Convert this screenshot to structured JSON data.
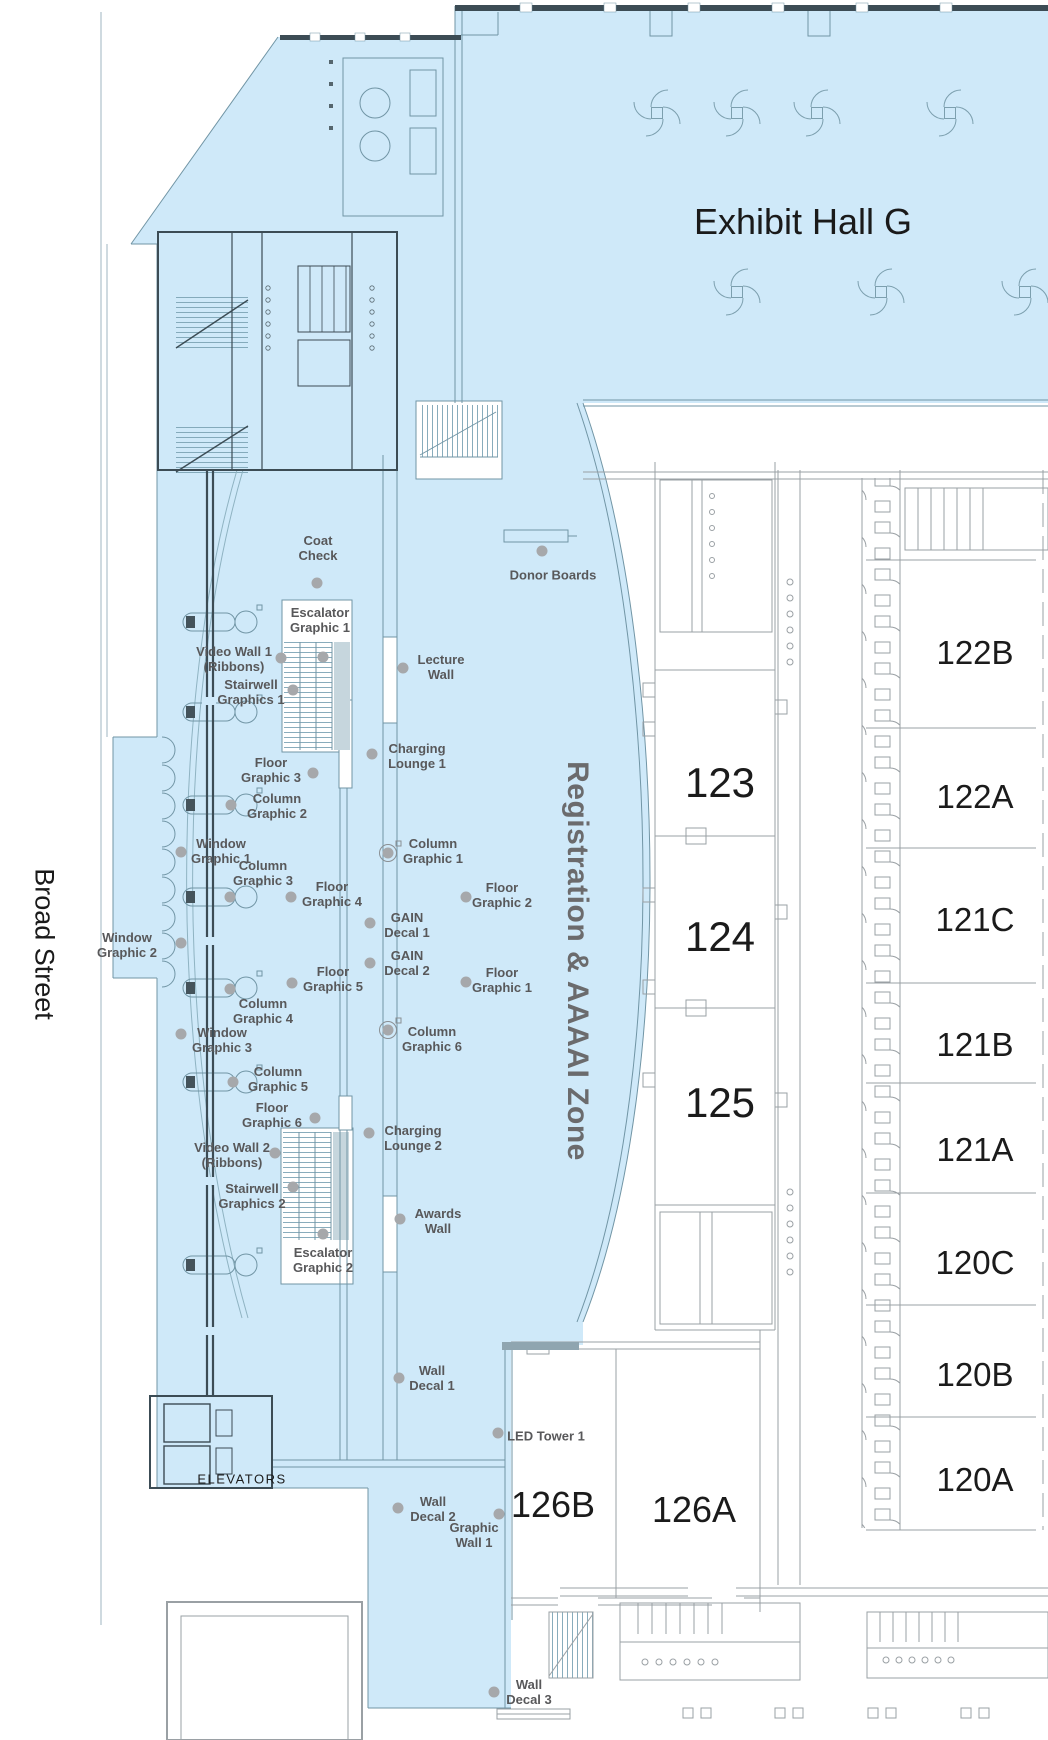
{
  "titles": {
    "hall": "Exhibit Hall G",
    "street": "Broad Street",
    "zone": "Registration & AAAAI Zone",
    "elevators": "ELEVATORS"
  },
  "colors": {
    "zone_fill": "#cfe9f9",
    "poi_label": "#58585a",
    "poi_dot": "#a6a8ab",
    "room_text": "#1b1b1b",
    "zone_text": "#6b6b6d"
  },
  "rooms": [
    {
      "label": "123",
      "x": 720,
      "y": 783,
      "size": 42
    },
    {
      "label": "124",
      "x": 720,
      "y": 937,
      "size": 42
    },
    {
      "label": "125",
      "x": 720,
      "y": 1103,
      "size": 42
    },
    {
      "label": "122B",
      "x": 975,
      "y": 653,
      "size": 33
    },
    {
      "label": "122A",
      "x": 975,
      "y": 797,
      "size": 33
    },
    {
      "label": "121C",
      "x": 975,
      "y": 920,
      "size": 33
    },
    {
      "label": "121B",
      "x": 975,
      "y": 1045,
      "size": 33
    },
    {
      "label": "121A",
      "x": 975,
      "y": 1150,
      "size": 33
    },
    {
      "label": "120C",
      "x": 975,
      "y": 1263,
      "size": 33
    },
    {
      "label": "120B",
      "x": 975,
      "y": 1375,
      "size": 33
    },
    {
      "label": "120A",
      "x": 975,
      "y": 1480,
      "size": 33
    },
    {
      "label": "126B",
      "x": 553,
      "y": 1505,
      "size": 36
    },
    {
      "label": "126A",
      "x": 694,
      "y": 1510,
      "size": 36
    }
  ],
  "pois": [
    {
      "id": "coat-check",
      "lines": [
        "Coat",
        "Check"
      ],
      "x": 318,
      "y": 549,
      "dot": {
        "x": 317,
        "y": 583
      }
    },
    {
      "id": "donor-boards",
      "lines": [
        "Donor Boards"
      ],
      "x": 553,
      "y": 576,
      "dot": {
        "x": 542,
        "y": 551
      }
    },
    {
      "id": "escalator-graphic-1",
      "lines": [
        "Escalator",
        "Graphic 1"
      ],
      "x": 320,
      "y": 621,
      "dot": {
        "x": 323,
        "y": 657
      }
    },
    {
      "id": "video-wall-1",
      "lines": [
        "Video Wall 1",
        "(Ribbons)"
      ],
      "x": 234,
      "y": 660,
      "dot": {
        "x": 281,
        "y": 658
      }
    },
    {
      "id": "stairwell-graphics-1",
      "lines": [
        "Stairwell",
        "Graphics 1"
      ],
      "x": 251,
      "y": 693,
      "dot": {
        "x": 293,
        "y": 690
      }
    },
    {
      "id": "lecture-wall",
      "lines": [
        "Lecture",
        "Wall"
      ],
      "x": 441,
      "y": 668,
      "dot": {
        "x": 403,
        "y": 668
      }
    },
    {
      "id": "charging-lounge-1",
      "lines": [
        "Charging",
        "Lounge 1"
      ],
      "x": 417,
      "y": 757,
      "dot": {
        "x": 372,
        "y": 754
      }
    },
    {
      "id": "floor-graphic-3",
      "lines": [
        "Floor",
        "Graphic 3"
      ],
      "x": 271,
      "y": 771,
      "dot": {
        "x": 313,
        "y": 773
      }
    },
    {
      "id": "column-graphic-2",
      "lines": [
        "Column",
        "Graphic 2"
      ],
      "x": 277,
      "y": 807,
      "dot": {
        "x": 231,
        "y": 805
      }
    },
    {
      "id": "window-graphic-1",
      "lines": [
        "Window",
        "Graphic 1"
      ],
      "x": 221,
      "y": 852,
      "dot": {
        "x": 181,
        "y": 852
      }
    },
    {
      "id": "column-graphic-3",
      "lines": [
        "Column",
        "Graphic 3"
      ],
      "x": 263,
      "y": 874,
      "dot": {
        "x": 230,
        "y": 897
      }
    },
    {
      "id": "column-graphic-1",
      "lines": [
        "Column",
        "Graphic 1"
      ],
      "x": 433,
      "y": 852,
      "dot": {
        "x": 388,
        "y": 853
      },
      "icon": "column"
    },
    {
      "id": "floor-graphic-4",
      "lines": [
        "Floor",
        "Graphic 4"
      ],
      "x": 332,
      "y": 895,
      "dot": {
        "x": 291,
        "y": 897
      }
    },
    {
      "id": "floor-graphic-2",
      "lines": [
        "Floor",
        "Graphic 2"
      ],
      "x": 502,
      "y": 896,
      "dot": {
        "x": 466,
        "y": 897
      }
    },
    {
      "id": "gain-decal-1",
      "lines": [
        "GAIN",
        "Decal 1"
      ],
      "x": 407,
      "y": 926,
      "dot": {
        "x": 370,
        "y": 923
      }
    },
    {
      "id": "gain-decal-2",
      "lines": [
        "GAIN",
        "Decal 2"
      ],
      "x": 407,
      "y": 964,
      "dot": {
        "x": 370,
        "y": 963
      }
    },
    {
      "id": "window-graphic-2",
      "lines": [
        "Window",
        "Graphic 2"
      ],
      "x": 127,
      "y": 946,
      "dot": {
        "x": 181,
        "y": 943
      }
    },
    {
      "id": "floor-graphic-5",
      "lines": [
        "Floor",
        "Graphic 5"
      ],
      "x": 333,
      "y": 980,
      "dot": {
        "x": 292,
        "y": 983
      }
    },
    {
      "id": "floor-graphic-1",
      "lines": [
        "Floor",
        "Graphic 1"
      ],
      "x": 502,
      "y": 981,
      "dot": {
        "x": 466,
        "y": 982
      }
    },
    {
      "id": "column-graphic-4",
      "lines": [
        "Column",
        "Graphic 4"
      ],
      "x": 263,
      "y": 1012,
      "dot": {
        "x": 230,
        "y": 989
      }
    },
    {
      "id": "window-graphic-3",
      "lines": [
        "Window",
        "Graphic 3"
      ],
      "x": 222,
      "y": 1041,
      "dot": {
        "x": 181,
        "y": 1034
      }
    },
    {
      "id": "column-graphic-6",
      "lines": [
        "Column",
        "Graphic 6"
      ],
      "x": 432,
      "y": 1040,
      "dot": {
        "x": 388,
        "y": 1030
      },
      "icon": "column"
    },
    {
      "id": "column-graphic-5",
      "lines": [
        "Column",
        "Graphic 5"
      ],
      "x": 278,
      "y": 1080,
      "dot": {
        "x": 233,
        "y": 1082
      }
    },
    {
      "id": "floor-graphic-6",
      "lines": [
        "Floor",
        "Graphic 6"
      ],
      "x": 272,
      "y": 1116,
      "dot": {
        "x": 315,
        "y": 1118
      }
    },
    {
      "id": "charging-lounge-2",
      "lines": [
        "Charging",
        "Lounge 2"
      ],
      "x": 413,
      "y": 1139,
      "dot": {
        "x": 369,
        "y": 1133
      }
    },
    {
      "id": "video-wall-2",
      "lines": [
        "Video Wall 2",
        "(Ribbons)"
      ],
      "x": 232,
      "y": 1156,
      "dot": {
        "x": 275,
        "y": 1153
      }
    },
    {
      "id": "stairwell-graphics-2",
      "lines": [
        "Stairwell",
        "Graphics 2"
      ],
      "x": 252,
      "y": 1197,
      "dot": {
        "x": 293,
        "y": 1187
      }
    },
    {
      "id": "awards-wall",
      "lines": [
        "Awards",
        "Wall"
      ],
      "x": 438,
      "y": 1222,
      "dot": {
        "x": 400,
        "y": 1219
      }
    },
    {
      "id": "escalator-graphic-2",
      "lines": [
        "Escalator",
        "Graphic 2"
      ],
      "x": 323,
      "y": 1261,
      "dot": {
        "x": 323,
        "y": 1234
      }
    },
    {
      "id": "wall-decal-1",
      "lines": [
        "Wall",
        "Decal 1"
      ],
      "x": 432,
      "y": 1379,
      "dot": {
        "x": 399,
        "y": 1378
      }
    },
    {
      "id": "led-tower-1",
      "lines": [
        "LED Tower 1"
      ],
      "x": 546,
      "y": 1437,
      "dot": {
        "x": 498,
        "y": 1433
      }
    },
    {
      "id": "wall-decal-2",
      "lines": [
        "Wall",
        "Decal 2"
      ],
      "x": 433,
      "y": 1510,
      "dot": {
        "x": 398,
        "y": 1508
      }
    },
    {
      "id": "graphic-wall-1",
      "lines": [
        "Graphic",
        "Wall 1"
      ],
      "x": 474,
      "y": 1536,
      "dot": {
        "x": 499,
        "y": 1514
      }
    },
    {
      "id": "wall-decal-3",
      "lines": [
        "Wall",
        "Decal 3"
      ],
      "x": 529,
      "y": 1693,
      "dot": {
        "x": 494,
        "y": 1692
      }
    }
  ]
}
